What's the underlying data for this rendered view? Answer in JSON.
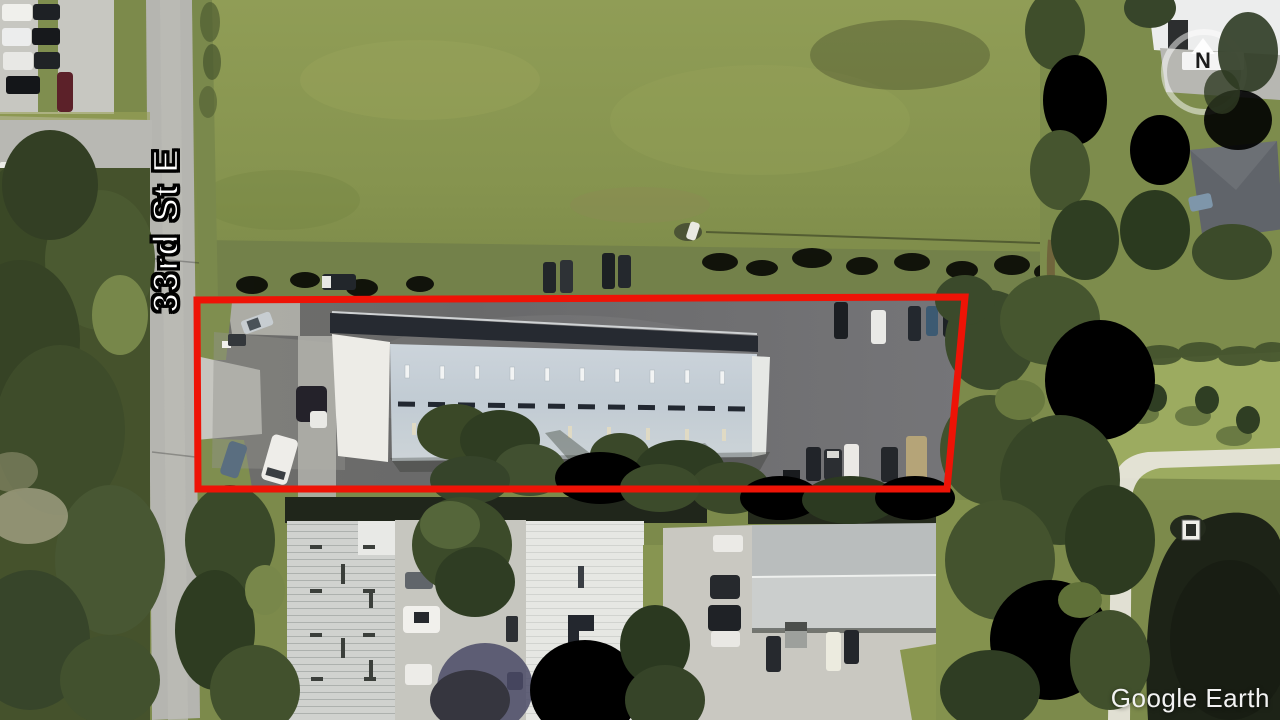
{
  "image": {
    "type": "satellite-aerial-photo",
    "source_watermark": "Google Earth"
  },
  "labels": {
    "street": "33rd St E",
    "compass_north": "N"
  },
  "annotation": {
    "parcel_outline_color": "#ee1306"
  }
}
